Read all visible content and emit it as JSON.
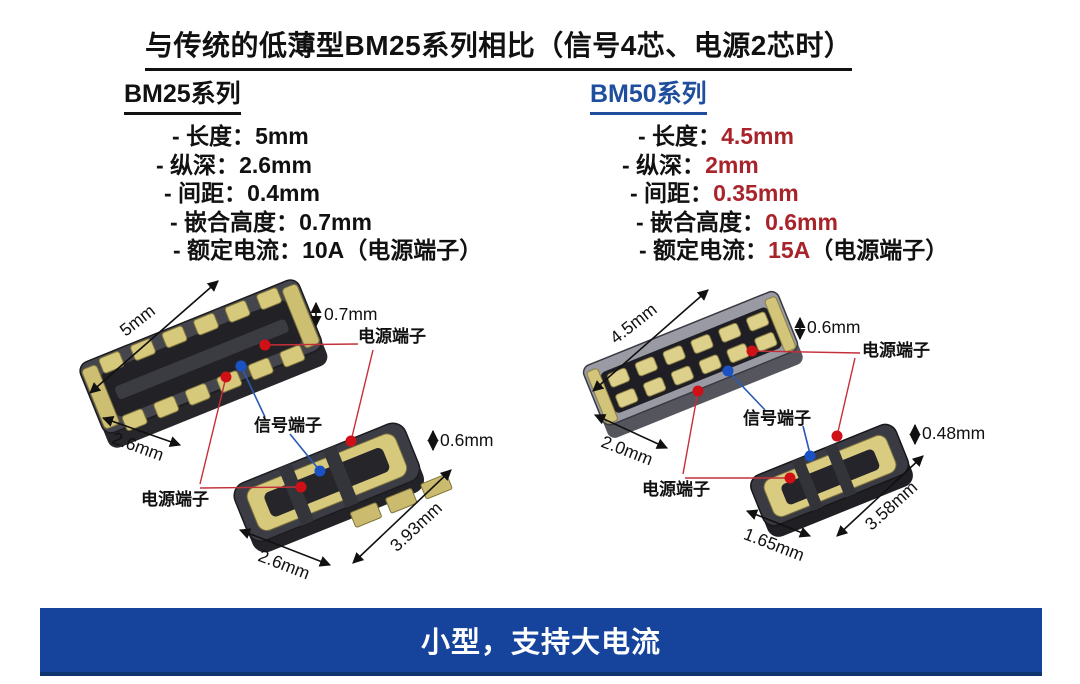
{
  "title": "与传统的低薄型BM25系列相比（信号4芯、电源2芯时）",
  "bm25": {
    "heading": "BM25系列",
    "specs": [
      {
        "label": "- 长度：",
        "value": "5mm",
        "suffix": ""
      },
      {
        "label": "- 纵深：",
        "value": "2.6mm",
        "suffix": ""
      },
      {
        "label": "- 间距：",
        "value": "0.4mm",
        "suffix": ""
      },
      {
        "label": "- 嵌合高度：",
        "value": "0.7mm",
        "suffix": ""
      },
      {
        "label": "- 额定电流：",
        "value": "10A",
        "suffix": "（电源端子）"
      }
    ],
    "diagram": {
      "receptacle_length": "5mm",
      "receptacle_height": "0.7mm",
      "receptacle_depth": "2.6mm",
      "plug_height": "0.6mm",
      "plug_length": "3.93mm",
      "plug_width": "2.6mm",
      "power_terminal_top": "电源端子",
      "power_terminal_bottom": "电源端子",
      "signal_terminal": "信号端子"
    }
  },
  "bm50": {
    "heading": "BM50系列",
    "specs": [
      {
        "label": "- 长度：",
        "value": "4.5mm",
        "suffix": ""
      },
      {
        "label": "- 纵深：",
        "value": "2mm",
        "suffix": ""
      },
      {
        "label": "- 间距：",
        "value": "0.35mm",
        "suffix": ""
      },
      {
        "label": "- 嵌合高度：",
        "value": "0.6mm",
        "suffix": ""
      },
      {
        "label": "- 额定电流：",
        "value": "15A",
        "suffix": "（电源端子）"
      }
    ],
    "diagram": {
      "receptacle_length": "4.5mm",
      "receptacle_height": "0.6mm",
      "receptacle_depth": "2.0mm",
      "plug_height": "0.48mm",
      "plug_length": "3.58mm",
      "plug_width": "1.65mm",
      "power_terminal_top": "电源端子",
      "power_terminal_bottom": "电源端子",
      "signal_terminal": "信号端子"
    }
  },
  "banner": {
    "text": "小型，支持大电流"
  },
  "colors": {
    "accent_blue": "#1f4e9e",
    "highlight_red": "#a8232a",
    "banner_blue": "#16449c",
    "power_line_red": "#c4303a",
    "signal_line_blue": "#2a5ab4",
    "power_dot_red": "#cf1016",
    "signal_dot_blue": "#1a52c4"
  }
}
